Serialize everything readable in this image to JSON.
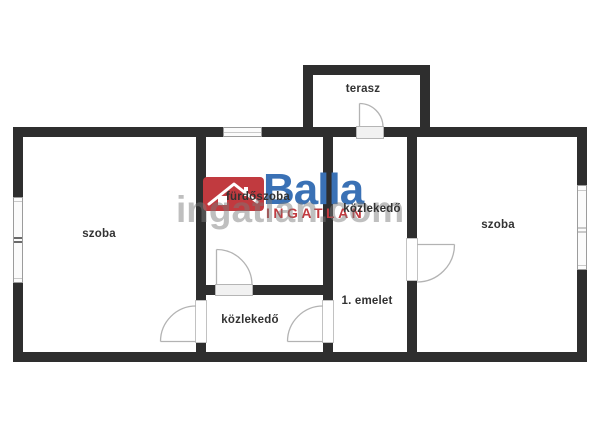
{
  "floor_plan": {
    "labels": {
      "room_left": "szoba",
      "room_right": "szoba",
      "bathroom": "fürdőszoba",
      "hallway_upper": "közlekedő",
      "hallway_lower": "közlekedő",
      "terrace": "terasz",
      "floor_note": "1. emelet"
    }
  },
  "watermark": {
    "brand": "Balla",
    "brand_sub": "INGATLAN",
    "background_text": "ingatlan.com"
  },
  "colors": {
    "wall": "#2e2e2e",
    "brand_blue": "#3a71b5",
    "brand_red": "#c13a3f",
    "watermark_gray": "#7a7a7a",
    "door_line": "#b3b3b3",
    "window_border": "#9c9c9c"
  }
}
